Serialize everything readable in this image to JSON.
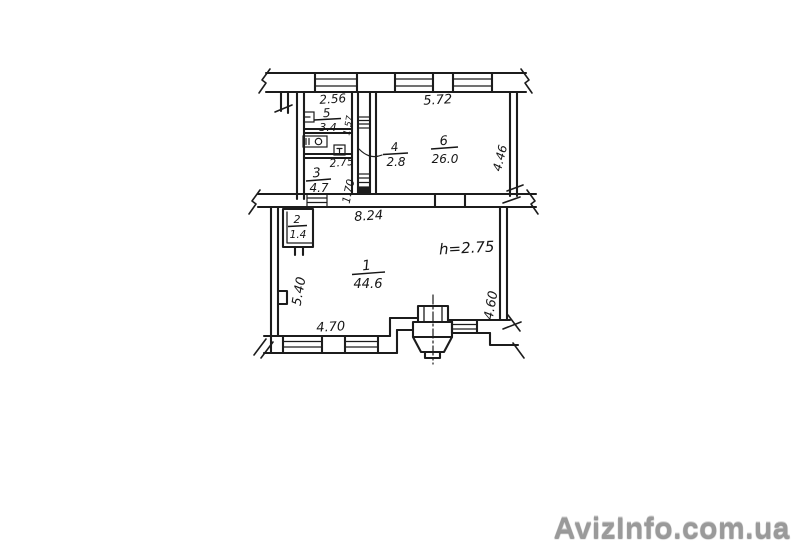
{
  "watermark": {
    "text": "AvizInfo.com.ua"
  },
  "plan": {
    "type": "apartment-floor-plan",
    "rooms": [
      {
        "number": "1",
        "area": "44.6"
      },
      {
        "number": "2",
        "area": "1.4"
      },
      {
        "number": "3",
        "area": "4.7"
      },
      {
        "number": "4",
        "area": "2.8"
      },
      {
        "number": "5",
        "area": "3.4"
      },
      {
        "number": "6",
        "area": "26.0"
      }
    ],
    "dimensions": {
      "upper_left_width": "2.56",
      "upper_right_width": "5.72",
      "upper_right_height": "4.46",
      "closet_depth": "1.57",
      "corridor_width": "2.75",
      "corridor_length": "1.70",
      "lower_width": "8.24",
      "lower_left_height": "5.40",
      "lower_right_height": "4.60",
      "lower_bottom_width": "4.70",
      "ceiling_height": "h=2.75"
    }
  }
}
